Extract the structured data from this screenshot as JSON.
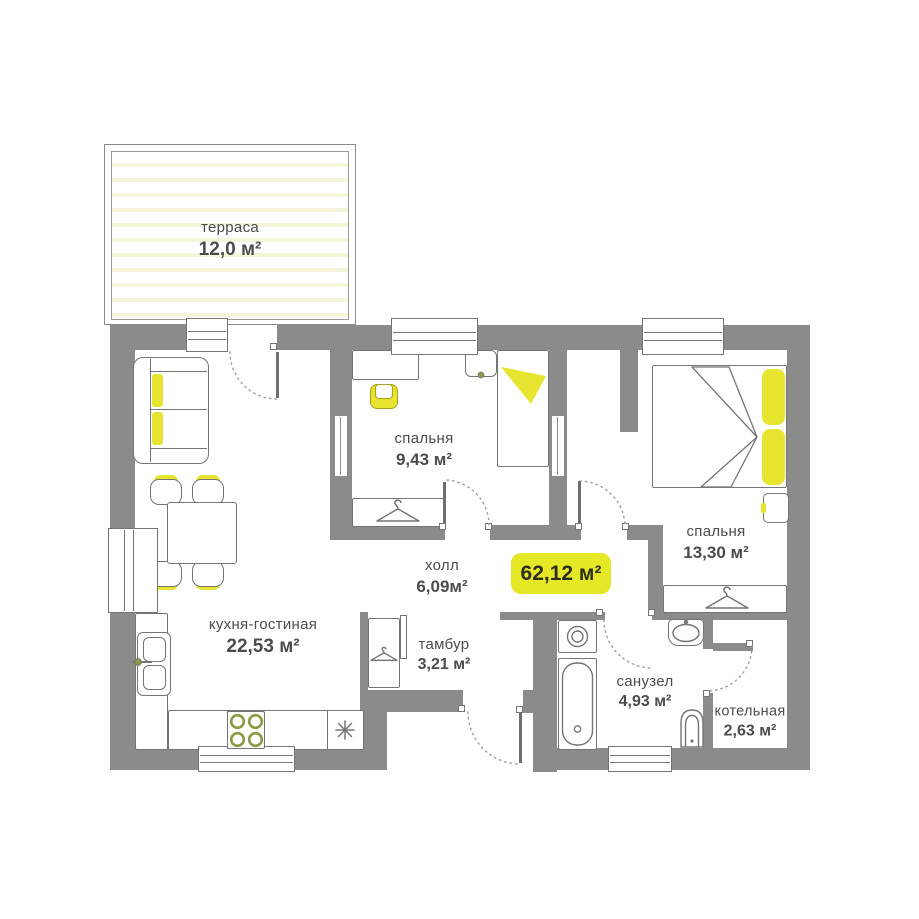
{
  "plan_title": "floor-plan",
  "rooms": {
    "terrace": {
      "name": "терраса",
      "area": "12,0 м²"
    },
    "bedroom1": {
      "name": "спальня",
      "area": "9,43 м²"
    },
    "bedroom2": {
      "name": "спальня",
      "area": "13,30 м²"
    },
    "hall": {
      "name": "холл",
      "area": "6,09м²"
    },
    "kitchen_living": {
      "name": "кухня-гостиная",
      "area": "22,53 м²"
    },
    "vestibule": {
      "name": "тамбур",
      "area": "3,21 м²"
    },
    "bathroom": {
      "name": "санузел",
      "area": "4,93 м²"
    },
    "boiler": {
      "name": "котельная",
      "area": "2,63 м²"
    }
  },
  "total_area": {
    "value": "62,12 м²"
  },
  "icons": {
    "hanger": "clothes-hanger-triangle",
    "snowflake": "eight-spoke-asterisk",
    "burner": "stove-burner-ring"
  },
  "colors": {
    "wall": "#8b8b8b",
    "accent_yellow": "#e8e531",
    "badge_yellow": "#e4e826",
    "outline": "#757575",
    "text": "#4c4c4c",
    "terrace_stripe": "#f5f5da",
    "burner_ring": "#8c9a44"
  }
}
